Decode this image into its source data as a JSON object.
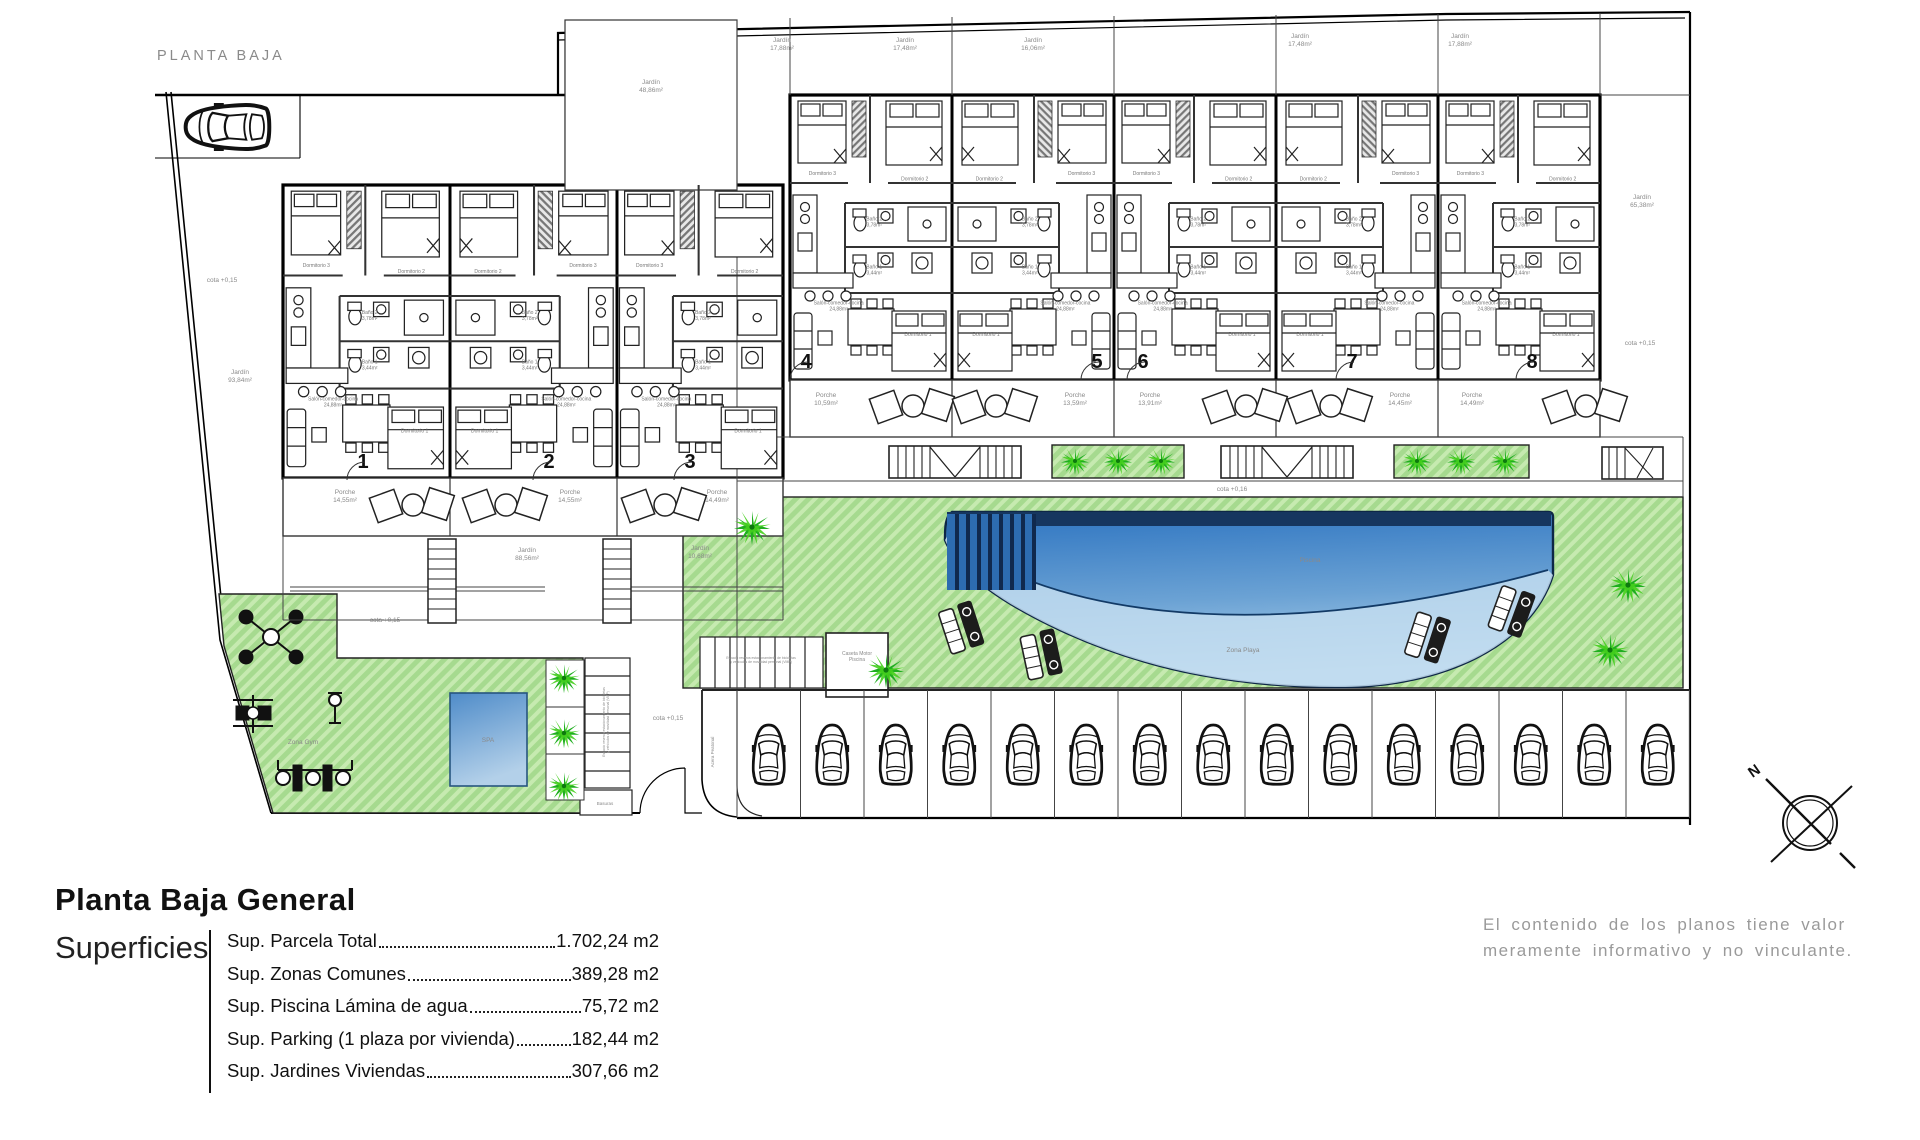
{
  "plan": {
    "label": "PLANTA BAJA",
    "compass_label": "N",
    "colors": {
      "grass": "#a6da8f",
      "grass_stripe": "#c6eab0",
      "pool_dark": "#16365f",
      "pool_mid": "#2d74c1",
      "pool_light": "#b7d7ee",
      "palm_dark": "#1fae1f",
      "palm_light": "#45cf1d",
      "label_gray": "#8a8a8a",
      "wall": "#000000"
    },
    "unit_numbers": [
      {
        "n": "1",
        "x": 363,
        "y": 468
      },
      {
        "n": "2",
        "x": 549,
        "y": 468
      },
      {
        "n": "3",
        "x": 690,
        "y": 468
      },
      {
        "n": "4",
        "x": 806,
        "y": 368
      },
      {
        "n": "5",
        "x": 1097,
        "y": 368
      },
      {
        "n": "6",
        "x": 1143,
        "y": 368
      },
      {
        "n": "7",
        "x": 1352,
        "y": 368
      },
      {
        "n": "8",
        "x": 1532,
        "y": 368
      }
    ],
    "room_labels": [
      {
        "t": "Dormitorio 3",
        "rx": 0.2,
        "ry": 0.28
      },
      {
        "t": "Dormitorio 2",
        "rx": 0.77,
        "ry": 0.3
      },
      {
        "t": "Baño 2|3,78m²",
        "rx": 0.52,
        "ry": 0.45
      },
      {
        "t": "Baño 1|3,44m²",
        "rx": 0.52,
        "ry": 0.62
      },
      {
        "t": "Salón-comedor-cocina|24,88m²",
        "rx": 0.3,
        "ry": 0.745
      },
      {
        "t": "Dormitorio 1",
        "rx": 0.79,
        "ry": 0.845
      }
    ],
    "buildings": {
      "left": {
        "x": 283,
        "y": 185,
        "w": 500,
        "h": 293,
        "units": 3,
        "mirror": [
          0,
          1,
          0
        ]
      },
      "right": {
        "x": 790,
        "y": 95,
        "w": 810,
        "h": 285,
        "units": 5,
        "mirror": [
          0,
          1,
          0,
          1,
          0
        ]
      }
    },
    "annotations": [
      {
        "t": "cota +0,15",
        "x": 222,
        "y": 282
      },
      {
        "t": "Jardín|93,84m²",
        "x": 240,
        "y": 378
      },
      {
        "t": "Jardín|88,56m²",
        "x": 527,
        "y": 556
      },
      {
        "t": "Jardín|10,68m²",
        "x": 700,
        "y": 554
      },
      {
        "t": "Jardín|48,86m²",
        "x": 651,
        "y": 88
      },
      {
        "t": "Jardín|17,88m²",
        "x": 782,
        "y": 46
      },
      {
        "t": "Jardín|17,48m²",
        "x": 905,
        "y": 46
      },
      {
        "t": "Jardín|16,06m²",
        "x": 1033,
        "y": 46
      },
      {
        "t": "Jardín|17,48m²",
        "x": 1300,
        "y": 42
      },
      {
        "t": "Jardín|17,88m²",
        "x": 1460,
        "y": 42
      },
      {
        "t": "Jardín|65,38m²",
        "x": 1642,
        "y": 203
      },
      {
        "t": "cota +0,15",
        "x": 1640,
        "y": 345
      },
      {
        "t": "cota +0,15",
        "x": 385,
        "y": 622
      },
      {
        "t": "cota +0,15",
        "x": 668,
        "y": 720
      },
      {
        "t": "cota +0,16",
        "x": 1232,
        "y": 491
      },
      {
        "t": "Piscina",
        "x": 1310,
        "y": 562
      },
      {
        "t": "Zona Playa",
        "x": 1243,
        "y": 652
      },
      {
        "t": "Zona Gym",
        "x": 303,
        "y": 744
      },
      {
        "t": "SPA",
        "x": 488,
        "y": 742
      },
      {
        "t": "Basuras",
        "x": 605,
        "y": 805,
        "s": 4.5
      },
      {
        "t": "Caseta Motor|Piscina",
        "x": 857,
        "y": 658,
        "s": 5
      },
      {
        "t": "Porche|14,55m²",
        "x": 345,
        "y": 498
      },
      {
        "t": "Porche|14,55m²",
        "x": 570,
        "y": 498
      },
      {
        "t": "Porche|14,49m²",
        "x": 717,
        "y": 498
      },
      {
        "t": "Porche|10,59m²",
        "x": 826,
        "y": 401
      },
      {
        "t": "Porche|13,59m²",
        "x": 1075,
        "y": 401
      },
      {
        "t": "Porche|13,91m²",
        "x": 1150,
        "y": 401
      },
      {
        "t": "Porche|14,45m²",
        "x": 1400,
        "y": 401
      },
      {
        "t": "Porche|14,49m²",
        "x": 1472,
        "y": 401
      },
      {
        "t": "Acera Peatonal",
        "x": 714,
        "y": 752,
        "r": -90,
        "s": 4.5
      },
      {
        "t": "Espacio reserva estacionamiento de bicicletas|y vehículos de movilidad personal (VMP)",
        "x": 607,
        "y": 722,
        "r": -90,
        "s": 3.4
      },
      {
        "t": "Espacio reserva estacionamiento de bicicletas|y vehículos de movilidad personal (VMP)",
        "x": 761,
        "y": 661,
        "s": 3.4
      }
    ],
    "parking": {
      "count": 15,
      "x0": 737,
      "pitch": 63.5,
      "top": 690,
      "bottom": 818
    },
    "car_single": {
      "x": 228,
      "y": 127
    },
    "palms": [
      [
        752,
        527,
        1
      ],
      [
        886,
        670,
        1
      ],
      [
        1628,
        585,
        1
      ],
      [
        1610,
        650,
        1
      ],
      [
        564,
        678,
        0.85
      ],
      [
        564,
        733,
        0.85
      ],
      [
        564,
        786,
        0.85
      ],
      [
        1075,
        461,
        0.78
      ],
      [
        1118,
        461,
        0.78
      ],
      [
        1161,
        461,
        0.78
      ],
      [
        1417,
        461,
        0.78
      ],
      [
        1461,
        461,
        0.78
      ],
      [
        1505,
        461,
        0.78
      ]
    ],
    "loungers": [
      [
        962,
        628,
        -18
      ],
      [
        1042,
        655,
        -12
      ],
      [
        1428,
        638,
        18
      ],
      [
        1512,
        612,
        20
      ]
    ],
    "porch_furniture": [
      [
        412,
        507
      ],
      [
        505,
        507
      ],
      [
        664,
        507
      ],
      [
        912,
        408
      ],
      [
        995,
        408
      ],
      [
        1245,
        408
      ],
      [
        1330,
        408
      ],
      [
        1585,
        408
      ]
    ]
  },
  "titleblock": {
    "title": "Planta Baja General",
    "section": "Superficies",
    "items": [
      {
        "label": "Sup. Parcela Total ",
        "value": "1.702,24 m2"
      },
      {
        "label": "Sup. Zonas Comunes ",
        "value": "389,28 m2"
      },
      {
        "label": "Sup. Piscina Lámina de agua",
        "value": "75,72 m2"
      },
      {
        "label": "Sup. Parking (1 plaza por vivienda)",
        "value": "182,44 m2"
      },
      {
        "label": "Sup. Jardines Viviendas",
        "value": "307,66 m2"
      }
    ]
  },
  "disclaimer": {
    "line1": "El contenido de los planos tiene valor",
    "line2": "meramente informativo y no vinculante."
  }
}
